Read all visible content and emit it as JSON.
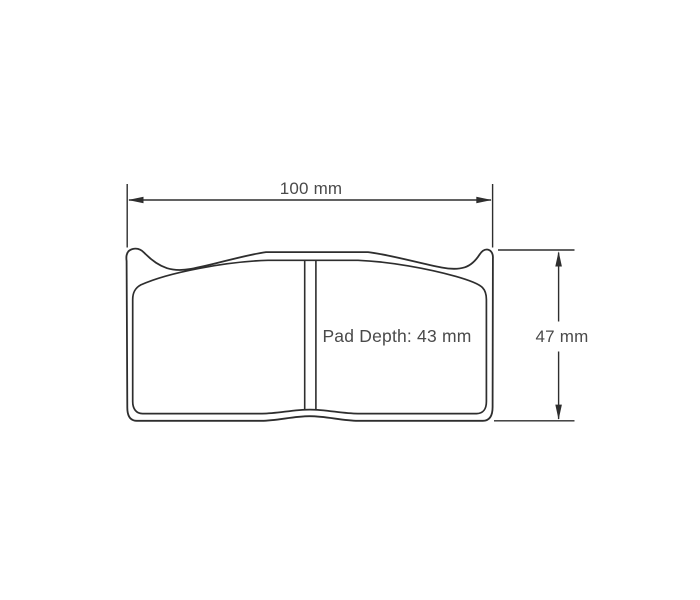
{
  "diagram": {
    "type": "technical-drawing",
    "subject": "brake-pad-outline-front-view",
    "line_color": "#2e2e2e",
    "text_color": "#4a4a4a",
    "background_color": "#ffffff",
    "labels": {
      "width": "100 mm",
      "height": "47 mm",
      "pad_depth": "Pad Depth: 43 mm"
    }
  }
}
